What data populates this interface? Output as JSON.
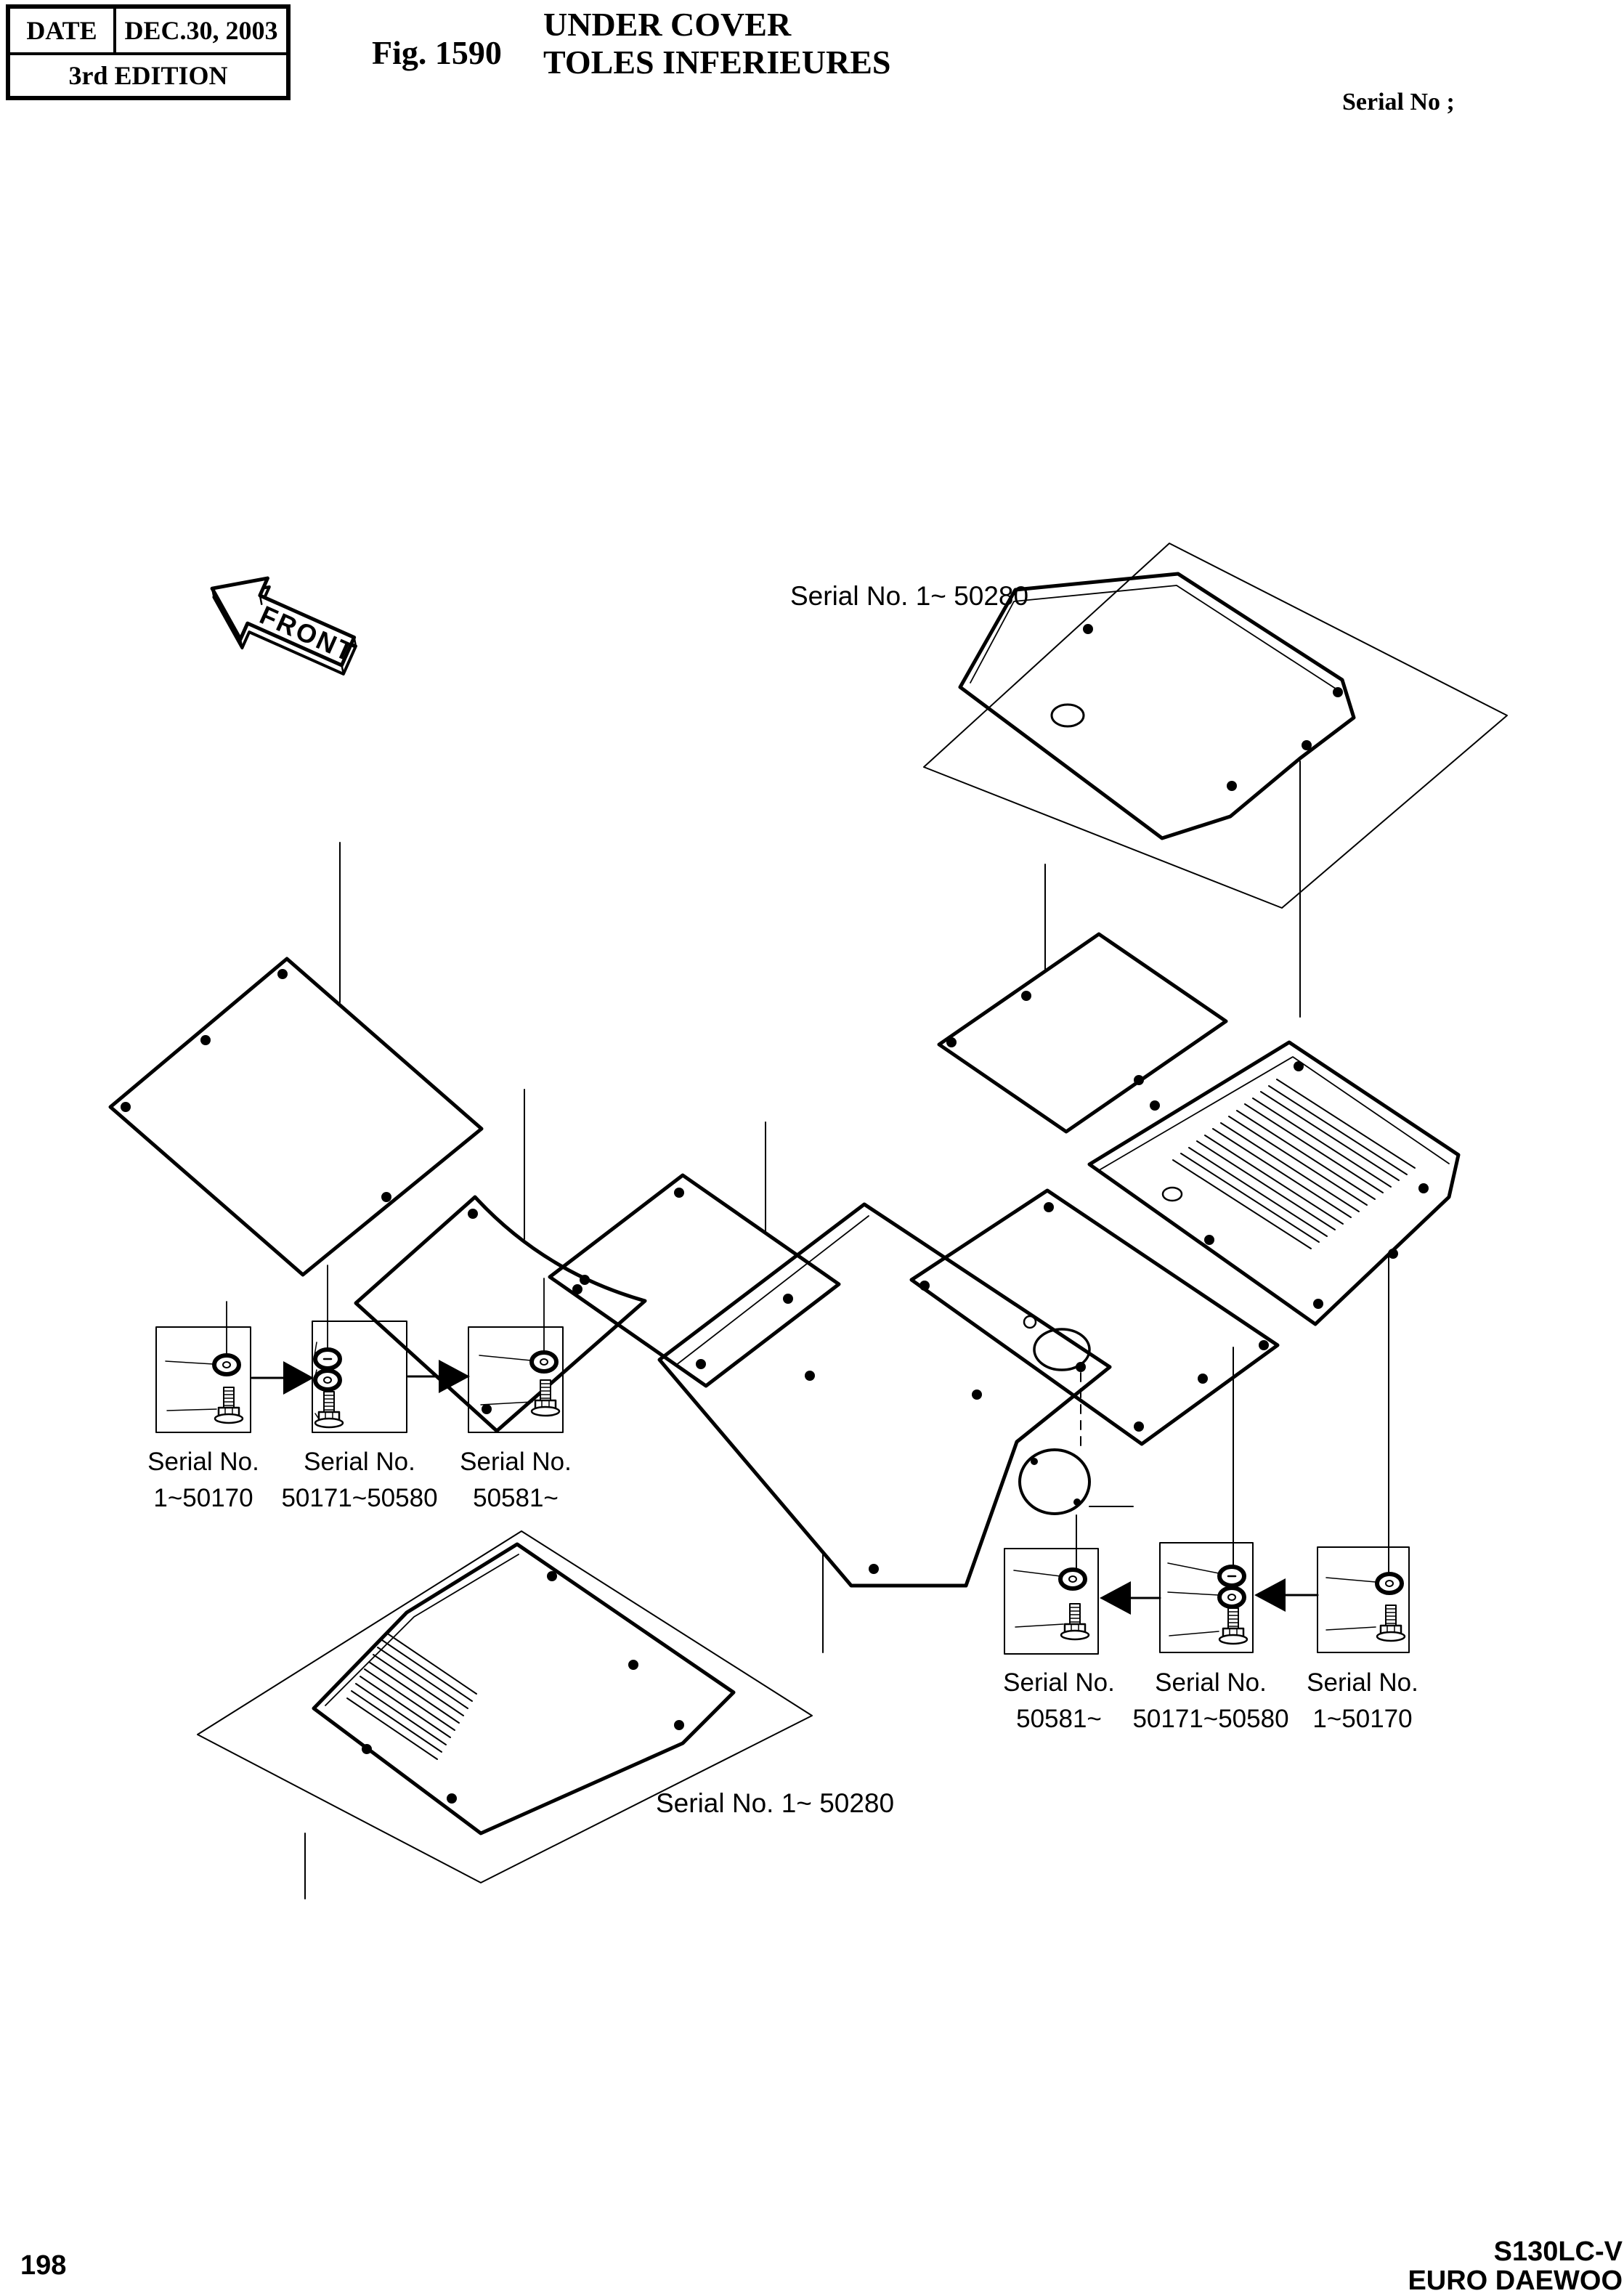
{
  "header": {
    "date_label": "DATE",
    "date_value": "DEC.30, 2003",
    "edition": "3rd EDITION",
    "fig_label": "Fig. 1590",
    "title_en": "UNDER COVER",
    "title_fr": "TOLES INFERIEURES",
    "serial_header": "Serial No ;"
  },
  "diagram": {
    "front_label": "FRONT",
    "top_serial_label": "Serial No. 1~ 50280",
    "bottom_serial_label": "Serial No. 1~ 50280",
    "left_boxes": [
      {
        "line1": "Serial No.",
        "line2": "1~50170"
      },
      {
        "line1": "Serial No.",
        "line2": "50171~50580"
      },
      {
        "line1": "Serial No.",
        "line2": "50581~"
      }
    ],
    "right_boxes": [
      {
        "line1": "Serial No.",
        "line2": "50581~"
      },
      {
        "line1": "Serial No.",
        "line2": "50171~50580"
      },
      {
        "line1": "Serial No.",
        "line2": "1~50170"
      }
    ]
  },
  "footer": {
    "page_number": "198",
    "model": "S130LC-V",
    "brand": "EURO DAEWOO"
  },
  "colors": {
    "line": "#000000",
    "background": "#ffffff"
  }
}
